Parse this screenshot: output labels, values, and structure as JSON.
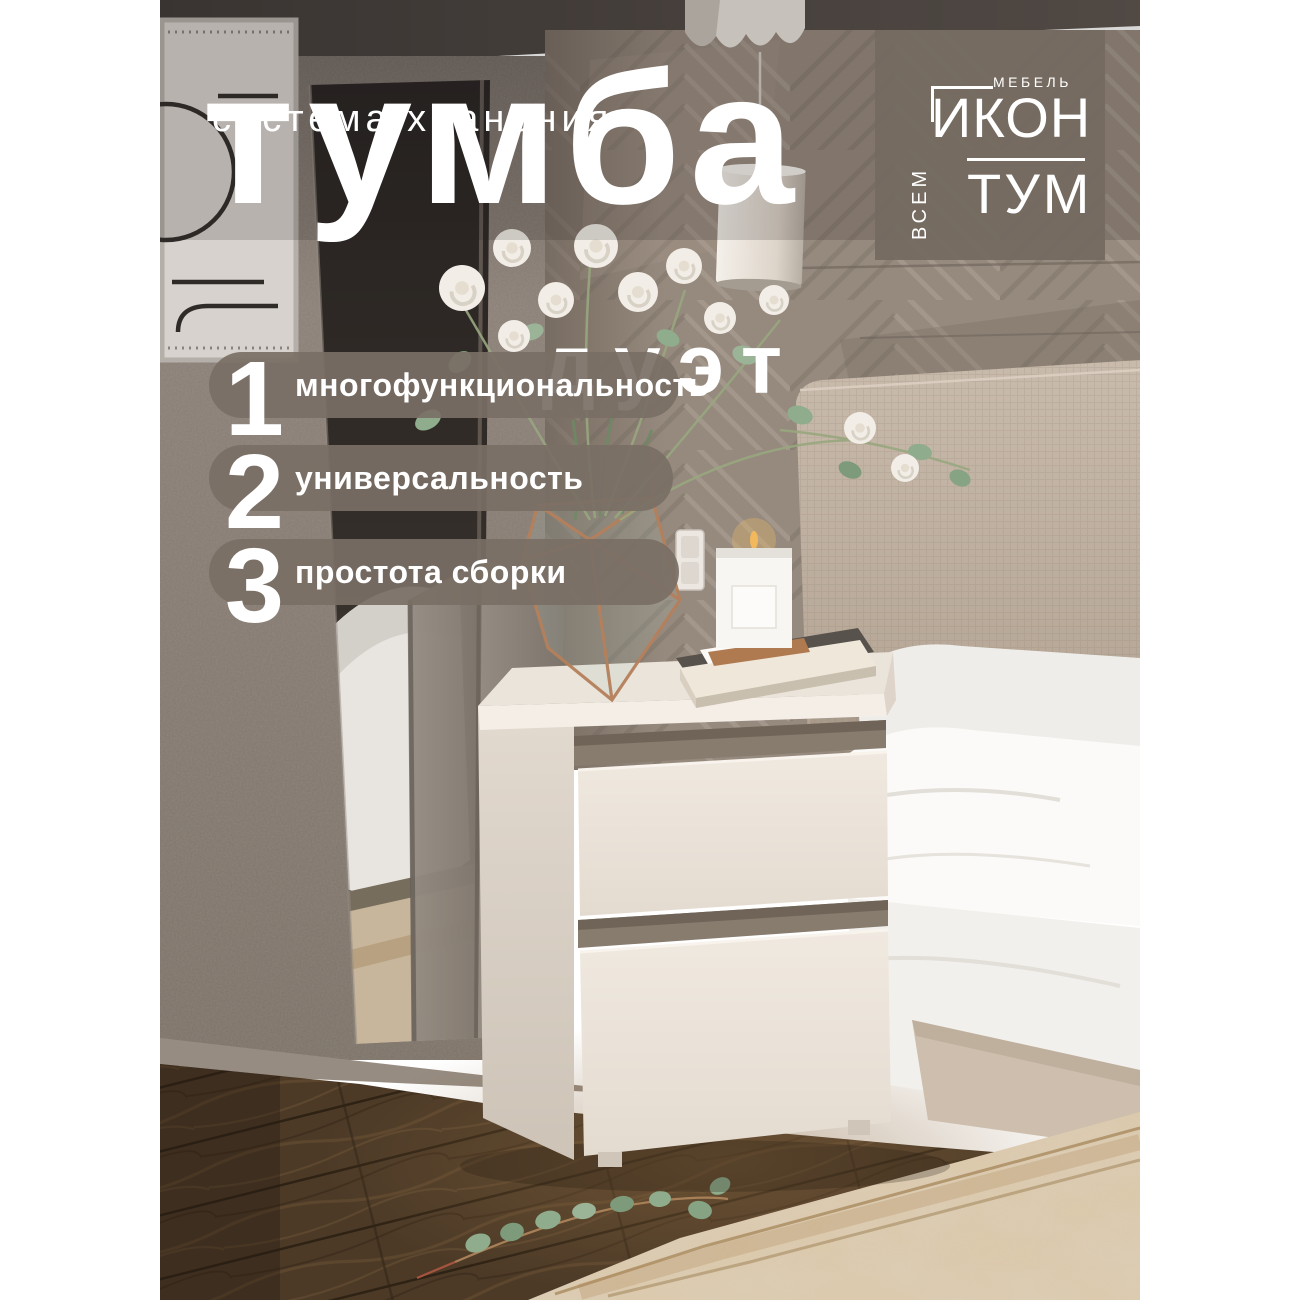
{
  "banner": {
    "tagline": "система хранения",
    "title": "тумба",
    "subtitle": "дуэт"
  },
  "features": [
    {
      "number": "1",
      "label": "многофункциональность"
    },
    {
      "number": "2",
      "label": "универсальность"
    },
    {
      "number": "3",
      "label": "простота сборки"
    }
  ],
  "logo": {
    "category": "МЕБЕЛЬ",
    "word_top": "ИКОН",
    "word_bottom": "ТУМ",
    "side_word": "ВСЕМ"
  },
  "colors": {
    "overlay_pill": "#796f65",
    "logo_bg": "#746a61",
    "text": "#ffffff",
    "wall": "#877c73",
    "panel_wall": "#96897d",
    "headboard": "#c1b3a4",
    "nightstand": "#ece4db",
    "floor": "#4c3a27",
    "rug": "#dccdb6",
    "copper": "#b5805c",
    "greenery": "#8fac8c"
  }
}
